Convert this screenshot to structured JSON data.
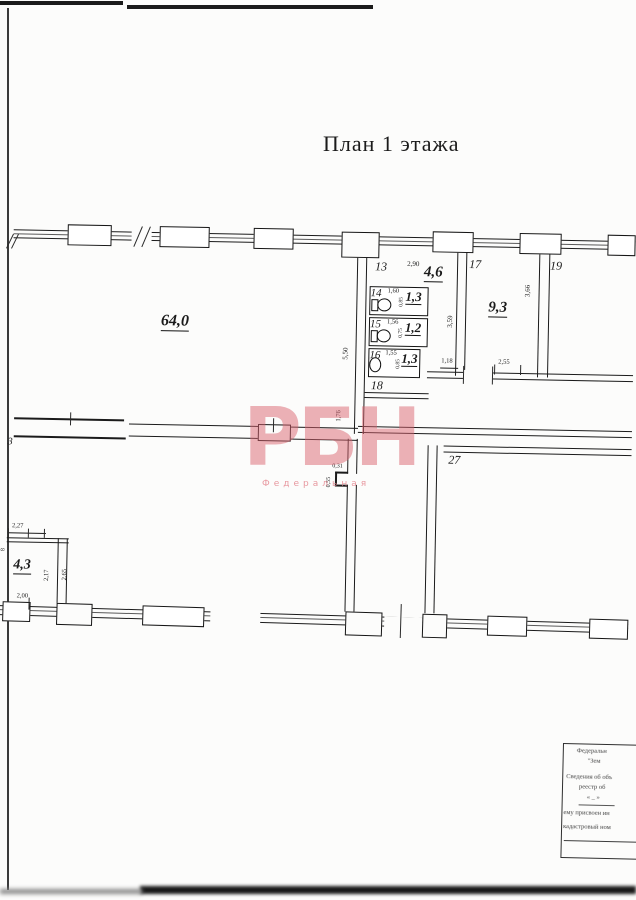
{
  "title": "План 1 этажа",
  "watermark": {
    "logo": "РБН",
    "subtitle": "Федеральная",
    "color": "#d96470"
  },
  "axes": {
    "left": "3"
  },
  "rooms": {
    "r64": {
      "area": "64,0",
      "height": "5,50"
    },
    "r13": {
      "number": "13",
      "width": "2,90",
      "area": "4,6"
    },
    "r14": {
      "number": "14",
      "width": "1,60",
      "depth": "0,85",
      "area": "1,3"
    },
    "r15": {
      "number": "15",
      "width": "1,56",
      "depth": "0,75",
      "area": "1,2"
    },
    "r16": {
      "number": "16",
      "width": "1,55",
      "depth": "0,85",
      "area": "1,3"
    },
    "r17": {
      "number": "17",
      "area": "9,3",
      "left_height": "3,59",
      "right_height": "3,66",
      "bottom_width": "2,55",
      "door_width": "1,18"
    },
    "r18": {
      "number": "18",
      "wall_height": "1,76"
    },
    "r19": {
      "number": "19"
    },
    "r27": {
      "number": "27",
      "notch_width": "0,31",
      "notch_height": "0,55"
    },
    "hall_right": {
      "area": "29,5",
      "length": "16,75"
    },
    "hall_left": {
      "area": "58,6",
      "height": "5,50",
      "corridor_length": "11,64",
      "window_width": "9,40"
    },
    "r43": {
      "area": "4,3",
      "top_width": "2,27",
      "inner_height": "2,17",
      "outer_height": "2,65",
      "bottom_width": "2,00",
      "axis": "8"
    }
  },
  "stamp": {
    "lines": [
      "Федеральн",
      "\"Зем",
      "Сведения об объ",
      "реестр об",
      "« _ »",
      "ему присвоен ин",
      "кадастровый ном"
    ]
  }
}
